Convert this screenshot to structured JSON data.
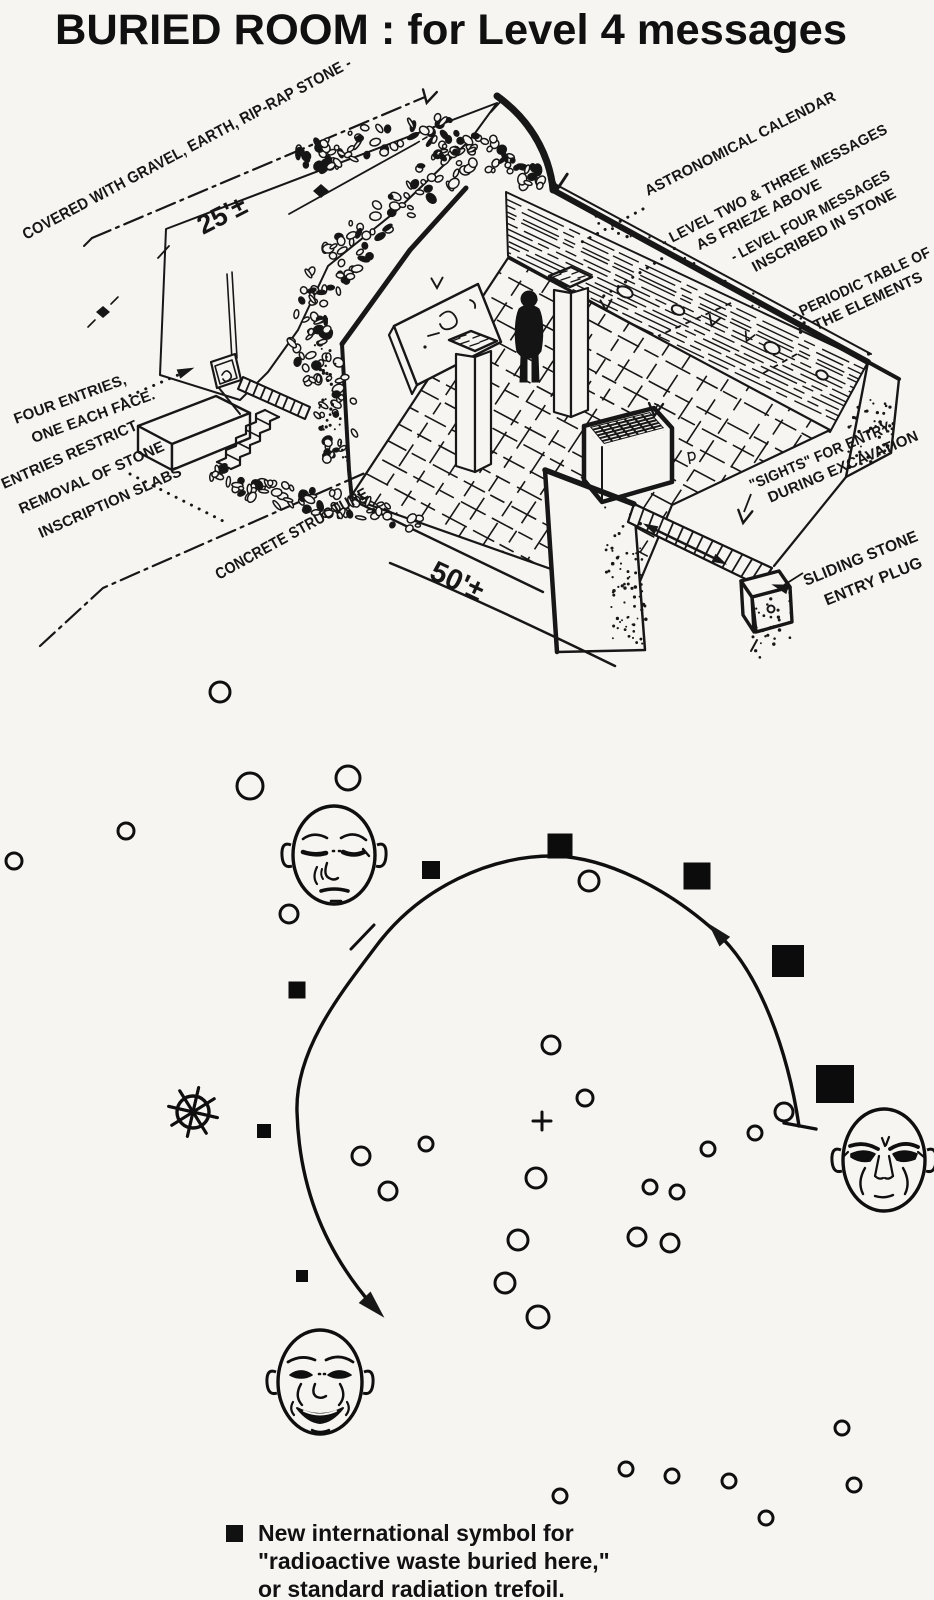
{
  "title": "BURIED ROOM :  for Level 4 messages",
  "sketch": {
    "dimension_labels": [
      {
        "id": "mound-height",
        "text": "25'±",
        "x": 203,
        "y": 235,
        "rot": -27,
        "size": 27
      },
      {
        "id": "room-width",
        "text": "50'±",
        "x": 428,
        "y": 578,
        "rot": 25,
        "size": 29
      }
    ],
    "annotations": [
      {
        "id": "covered",
        "x": 26,
        "y": 240,
        "rot": -28,
        "size": 16,
        "lh": 19,
        "lines": [
          {
            "t": "COVERED WITH GRAVEL, EARTH, RIP-RAP STONE -",
            "len": 370
          }
        ]
      },
      {
        "id": "astronomical-calendar",
        "x": 648,
        "y": 196,
        "rot": -27,
        "size": 15,
        "lh": 19,
        "lines": [
          {
            "t": "ASTRONOMICAL CALENDAR",
            "len": 212
          }
        ]
      },
      {
        "id": "level-two-three",
        "x": 664,
        "y": 247,
        "rot": -27,
        "size": 15,
        "lh": 19,
        "lines": [
          {
            "t": "- LEVEL TWO & THREE MESSAGES",
            "len": 252
          },
          {
            "t": "AS FRIEZE ABOVE",
            "dx": 30
          }
        ]
      },
      {
        "id": "level-four",
        "x": 734,
        "y": 262,
        "rot": -28,
        "size": 15,
        "lh": 19,
        "lines": [
          {
            "t": "- LEVEL FOUR MESSAGES",
            "len": 178
          },
          {
            "t": "INSCRIBED IN STONE",
            "dx": 14
          }
        ]
      },
      {
        "id": "periodic-table",
        "x": 794,
        "y": 320,
        "rot": -25,
        "size": 15,
        "lh": 19,
        "lines": [
          {
            "t": "- PERIODIC TABLE OF",
            "len": 152
          },
          {
            "t": "THE ELEMENTS",
            "dx": 16
          }
        ]
      },
      {
        "id": "four-entries",
        "x": 16,
        "y": 424,
        "rot": -20,
        "size": 15,
        "lh": 24,
        "lines": [
          {
            "t": "FOUR ENTRIES,"
          },
          {
            "t": "ONE EACH FACE.",
            "dx": 10
          }
        ]
      },
      {
        "id": "entries-restrict",
        "x": 4,
        "y": 489,
        "rot": -24,
        "size": 15,
        "lh": 30,
        "lines": [
          {
            "t": "ENTRIES RESTRICT"
          },
          {
            "t": "REMOVAL OF STONE",
            "dx": 6
          },
          {
            "t": "INSCRIPTION SLABS",
            "dx": 14
          }
        ]
      },
      {
        "id": "concrete-structure",
        "x": 219,
        "y": 580,
        "rot": -29,
        "size": 16,
        "lh": 19,
        "lines": [
          {
            "t": "CONCRETE STRUCTURE",
            "len": 172
          }
        ]
      },
      {
        "id": "sights",
        "x": 752,
        "y": 490,
        "rot": -23,
        "size": 15,
        "lh": 19,
        "lines": [
          {
            "t": "\"SIGHTS\" FOR ENTRY",
            "len": 152
          },
          {
            "t": "DURING EXCAVATION",
            "dx": 12
          }
        ]
      },
      {
        "id": "sliding-stone",
        "x": 806,
        "y": 586,
        "rot": -22,
        "size": 16,
        "lh": 26,
        "lines": [
          {
            "t": "SLIDING STONE",
            "len": 122
          },
          {
            "t": "ENTRY PLUG",
            "dx": 12
          }
        ]
      }
    ]
  },
  "star_map": {
    "description": "sky chart: open-circle stars, filled squares marking buried radioactive waste, three carved faces, sun wheel, center cross, counterclockwise arc",
    "circles": [
      [
        220,
        692,
        10
      ],
      [
        250,
        786,
        13
      ],
      [
        348,
        778,
        12
      ],
      [
        126,
        831,
        8
      ],
      [
        14,
        861,
        8
      ],
      [
        289,
        914,
        9
      ],
      [
        589,
        881,
        10
      ],
      [
        551,
        1045,
        9
      ],
      [
        585,
        1098,
        8
      ],
      [
        536,
        1178,
        10
      ],
      [
        518,
        1240,
        10
      ],
      [
        505,
        1283,
        10
      ],
      [
        538,
        1317,
        11
      ],
      [
        650,
        1187,
        7
      ],
      [
        677,
        1192,
        7
      ],
      [
        637,
        1237,
        9
      ],
      [
        670,
        1243,
        9
      ],
      [
        708,
        1149,
        7
      ],
      [
        755,
        1133,
        7
      ],
      [
        784,
        1112,
        9
      ],
      [
        361,
        1156,
        9
      ],
      [
        426,
        1144,
        7
      ],
      [
        388,
        1191,
        9
      ],
      [
        842,
        1428,
        7
      ],
      [
        626,
        1469,
        7
      ],
      [
        672,
        1476,
        7
      ],
      [
        729,
        1481,
        7
      ],
      [
        560,
        1496,
        7
      ],
      [
        766,
        1518,
        7
      ],
      [
        854,
        1485,
        7
      ]
    ],
    "squares": [
      [
        431,
        870,
        18
      ],
      [
        297,
        990,
        17
      ],
      [
        560,
        846,
        25
      ],
      [
        697,
        876,
        27
      ],
      [
        788,
        961,
        32
      ],
      [
        835,
        1084,
        38
      ],
      [
        264,
        1131,
        14
      ],
      [
        302,
        1276,
        12
      ]
    ],
    "faces": [
      {
        "x": 334,
        "y": 855,
        "rx": 41,
        "ry": 49,
        "expression": "serene"
      },
      {
        "x": 884,
        "y": 1160,
        "rx": 41,
        "ry": 51,
        "expression": "angry"
      },
      {
        "x": 320,
        "y": 1382,
        "rx": 42,
        "ry": 52,
        "expression": "smiling"
      }
    ],
    "sun_wheel": {
      "x": 193,
      "y": 1112,
      "rim_r": 16,
      "spoke_r": 25,
      "spokes": 8
    },
    "center_cross": {
      "x": 542,
      "y": 1121,
      "arm": 9
    },
    "arc": {
      "start": [
        799,
        1126
      ],
      "end": [
        372,
        1305
      ],
      "direction": "counterclockwise"
    }
  },
  "legend": {
    "symbol": "filled-square",
    "lines": [
      "New international symbol for",
      "\"radioactive waste buried here,\"",
      "or standard radiation trefoil."
    ]
  }
}
